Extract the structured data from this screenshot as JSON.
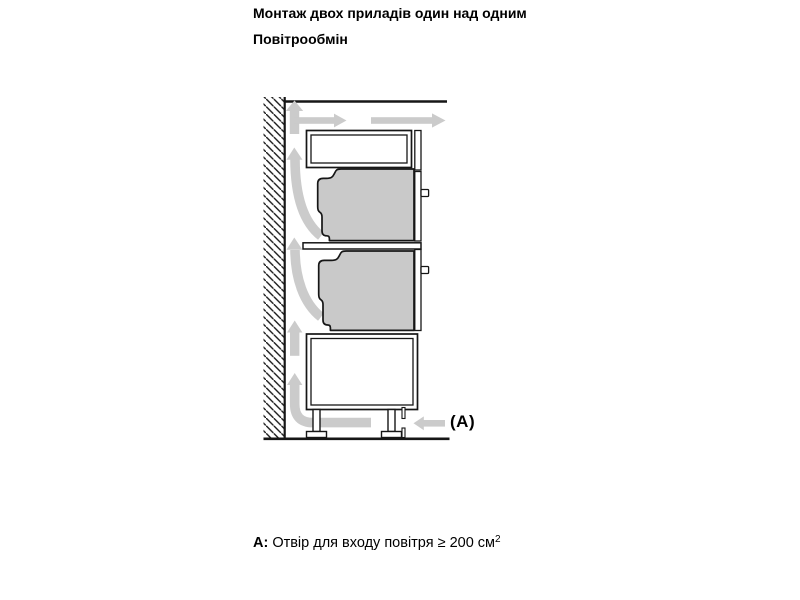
{
  "header": {
    "title": "Монтаж двох приладів один над одним",
    "subtitle": "Повітрообмін"
  },
  "diagram": {
    "description": "Side-view installation schematic: two built-in ovens stacked in a tall cabinet against a hatched wall, gray arrows showing air circulation behind and under the cabinet",
    "inlet_label": "(A)",
    "colors": {
      "line": "#161616",
      "appliance_fill": "#c9c9c9",
      "arrow_fill": "#cbcbcb",
      "background": "#ffffff"
    }
  },
  "footnote": {
    "label": "A:",
    "text": "Отвір для входу повітря ≥ 200 см",
    "superscript": "2"
  }
}
